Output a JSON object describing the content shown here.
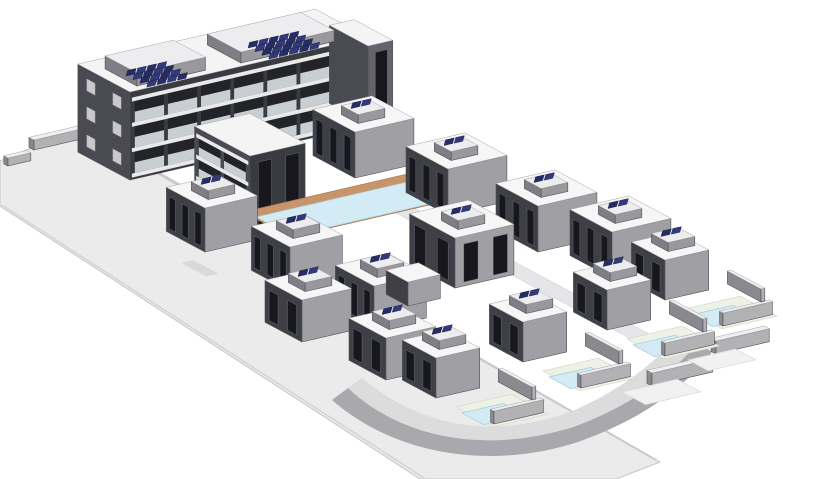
{
  "scene": {
    "name": "residential-complex-3d-axonometric-render",
    "canvas": {
      "width": 815,
      "height": 479,
      "background": "#ffffff"
    },
    "projection": {
      "u": [
        0.95,
        -0.22
      ],
      "v": [
        0.84,
        0.45
      ]
    },
    "palette": {
      "road": "#ebebeb",
      "roadEdge": "#c4c4c6",
      "street": "#e6e6e8",
      "drive": "#d9d9da",
      "curve": "#a9a9ad",
      "curveWalk": "#dcdcdd",
      "wallL": "#8a8a8e",
      "wallR": "#b2b2b5",
      "wallTop": "#efeff0",
      "houseL": "#3f3f46",
      "houseR": "#a0a0a4",
      "houseTop": "#f6f6f7",
      "aptL": "#4a4a52",
      "aptR": "#3a3a41",
      "aptTop": "#f4f4f5",
      "aptR2": "#63636b",
      "rbL": "#7e7e84",
      "rbR": "#98989d",
      "rbTop": "#ededef",
      "window": "#17171d",
      "winFrame": "#6a7688",
      "balcony": "#23232a",
      "railing": "#c9ced2",
      "slab": "#e9e9ea",
      "sqwin": "#c9c9cc",
      "solar": "#262c66",
      "solar2": "#323a7d",
      "solarEdge": "#141839",
      "deck": "#c8956a",
      "deckEdge": "#a87848",
      "water": "#d3ebf4",
      "waterEdge": "#a5ccda",
      "garden": "#edf1e6",
      "gardenEdge": "#d3dac6",
      "edge": "#4f4f57",
      "topEdge": "#a6a6aa"
    },
    "items": [
      {
        "t": "poly",
        "name": "main-road",
        "pts": [
          [
            86,
            130
          ],
          [
            660,
            462
          ],
          [
            616,
            479
          ],
          [
            420,
            479
          ],
          [
            0,
            206
          ],
          [
            0,
            161
          ],
          [
            55,
            138
          ]
        ],
        "fill": "road",
        "stroke": "roadEdge",
        "sw": 1
      },
      {
        "t": "path",
        "name": "road-upper-curb",
        "d": "M 86 132 L 656 460",
        "stroke": "#c9c9cb",
        "sw": 2
      },
      {
        "t": "path",
        "name": "road-lower-edge",
        "d": "M 2 205 L 424 478",
        "stroke": "#d4d4d5",
        "sw": 1.5
      },
      {
        "t": "box",
        "name": "retaining-wall-1",
        "a": [
          34,
          150
        ],
        "w": 55,
        "d": 6,
        "h": 10
      },
      {
        "t": "box",
        "name": "retaining-wall-2",
        "a": [
          8,
          166
        ],
        "w": 24,
        "d": 5,
        "h": 8
      },
      {
        "t": "rect",
        "name": "inner-street",
        "a": [
          383,
          206
        ],
        "w": 20,
        "d": 330,
        "fill": "street",
        "stroke": "#d5d5d6"
      },
      {
        "t": "path",
        "name": "curved-road",
        "d": "M 332 400 C 396 456 492 470 578 442 C 640 420 682 390 712 352 L 698 342 C 670 376 634 404 576 426 C 496 452 408 444 348 388 Z",
        "fill": "curve"
      },
      {
        "t": "path",
        "name": "curved-sidewalk",
        "d": "M 348 388 C 408 444 496 452 576 426 C 634 404 670 376 698 342 L 682 331 C 656 362 622 390 570 412 C 498 438 424 430 362 378 Z",
        "fill": "curveWalk"
      },
      {
        "t": "rect",
        "name": "driveway-1",
        "a": [
          181,
          263
        ],
        "w": 13,
        "d": 30,
        "fill": "drive"
      },
      {
        "t": "rect",
        "name": "driveway-2",
        "a": [
          266,
          302
        ],
        "w": 13,
        "d": 30,
        "fill": "drive"
      },
      {
        "t": "rect",
        "name": "driveway-3",
        "a": [
          350,
          340
        ],
        "w": 13,
        "d": 30,
        "fill": "drive"
      },
      {
        "t": "box",
        "name": "apartment-block",
        "a": [
          130,
          180
        ],
        "w": 250,
        "d": 62,
        "h": 88,
        "top": "aptTop",
        "left": "aptL",
        "right": "aptR"
      },
      {
        "t": "balc",
        "name": "apartment-balconies",
        "a": [
          130,
          180
        ],
        "w": 250,
        "h": 88,
        "rows": 3,
        "cols": 7
      },
      {
        "t": "sqwin",
        "name": "apartment-end-windows",
        "a": [
          130,
          180
        ],
        "d": 62,
        "h": 88,
        "rows": 3,
        "cols": 2
      },
      {
        "t": "box",
        "name": "apartment-end-block",
        "a": [
          368,
          124
        ],
        "w": 26,
        "d": 46,
        "h": 78,
        "top": "aptTop",
        "left": "aptL",
        "right": "aptR2"
      },
      {
        "t": "winR",
        "name": "apartment-end-block-windows",
        "a": [
          368,
          124
        ],
        "w": 26,
        "h": 78,
        "n": 1
      },
      {
        "t": "box",
        "name": "apartment-roof-house-1",
        "a": [
          137,
          86
        ],
        "w": 72,
        "d": 38,
        "h": 13,
        "top": "rbTop",
        "left": "rbL",
        "right": "rbR"
      },
      {
        "t": "solar",
        "name": "solar-array-1",
        "at": [
          126,
          76
        ],
        "rows": 4,
        "cols": 4
      },
      {
        "t": "box",
        "name": "apartment-roof-house-2",
        "a": [
          241,
          63
        ],
        "w": 98,
        "d": 40,
        "h": 11,
        "top": "rbTop",
        "left": "rbL",
        "right": "rbR"
      },
      {
        "t": "solar",
        "name": "solar-array-2",
        "at": [
          248,
          48
        ],
        "rows": 4,
        "cols": 5
      },
      {
        "t": "box",
        "name": "apartment-wing",
        "a": [
          250,
          232
        ],
        "w": 58,
        "d": 66,
        "h": 76,
        "top": "aptTop",
        "left": "aptL",
        "right": "aptR"
      },
      {
        "t": "balcL",
        "name": "apartment-wing-balconies",
        "a": [
          250,
          232
        ],
        "d": 66,
        "h": 76,
        "rows": 3,
        "cols": 2
      },
      {
        "t": "winR",
        "name": "apartment-wing-windows",
        "a": [
          250,
          232
        ],
        "w": 58,
        "h": 76,
        "n": 2
      },
      {
        "t": "rect",
        "name": "pool-deck",
        "a": [
          243,
          212
        ],
        "w": 185,
        "d": 56,
        "fill": "deck",
        "stroke": "deckEdge"
      },
      {
        "t": "rect",
        "name": "pool-water",
        "a": [
          256,
          217
        ],
        "w": 160,
        "d": 42,
        "fill": "water",
        "stroke": "waterEdge"
      },
      {
        "t": "house",
        "name": "townhouse-l1",
        "a": [
          205,
          252
        ],
        "w": 55,
        "d": 46,
        "h": 44,
        "win": 3
      },
      {
        "t": "house",
        "name": "townhouse-l2",
        "a": [
          290,
          291
        ],
        "w": 55,
        "d": 46,
        "h": 44,
        "win": 3
      },
      {
        "t": "house",
        "name": "townhouse-l3",
        "a": [
          374,
          330
        ],
        "w": 55,
        "d": 46,
        "h": 44,
        "win": 3
      },
      {
        "t": "house",
        "name": "townhouse-r1",
        "a": [
          355,
          178
        ],
        "w": 62,
        "d": 50,
        "h": 46,
        "win": 3
      },
      {
        "t": "house",
        "name": "townhouse-r2",
        "a": [
          448,
          215
        ],
        "w": 62,
        "d": 50,
        "h": 46,
        "win": 3
      },
      {
        "t": "house",
        "name": "townhouse-r3",
        "a": [
          538,
          252
        ],
        "w": 62,
        "d": 50,
        "h": 46,
        "win": 3
      },
      {
        "t": "house",
        "name": "townhouse-r4",
        "a": [
          612,
          278
        ],
        "w": 62,
        "d": 50,
        "h": 46,
        "win": 3
      },
      {
        "t": "house",
        "name": "pool-house",
        "a": [
          455,
          288
        ],
        "w": 62,
        "d": 54,
        "h": 50,
        "win": 2
      },
      {
        "t": "winR",
        "name": "pool-house-windows",
        "a": [
          455,
          288
        ],
        "w": 62,
        "h": 50,
        "n": 2
      },
      {
        "t": "box",
        "name": "pool-house-wing",
        "a": [
          408,
          306
        ],
        "w": 34,
        "d": 26,
        "h": 24,
        "top": "houseTop",
        "left": "houseL",
        "right": "houseR"
      },
      {
        "t": "house",
        "name": "house-m1",
        "a": [
          302,
          342
        ],
        "w": 52,
        "d": 44,
        "h": 42,
        "win": 2
      },
      {
        "t": "house",
        "name": "house-m2",
        "a": [
          386,
          380
        ],
        "w": 52,
        "d": 44,
        "h": 42,
        "win": 2
      },
      {
        "t": "box",
        "name": "terrace-wall-1",
        "a": [
          652,
          386
        ],
        "w": 64,
        "d": 6,
        "h": 13
      },
      {
        "t": "box",
        "name": "terrace-wall-2",
        "a": [
          716,
          354
        ],
        "w": 56,
        "d": 6,
        "h": 13
      },
      {
        "t": "rect",
        "name": "terrace-platform-1",
        "a": [
          622,
          392
        ],
        "w": 58,
        "d": 28,
        "fill": "#f1f1f2",
        "stroke": "#d8d8d9"
      },
      {
        "t": "rect",
        "name": "terrace-platform-2",
        "a": [
          688,
          360
        ],
        "w": 50,
        "d": 24,
        "fill": "#f1f1f2",
        "stroke": "#d8d8d9"
      },
      {
        "t": "villa",
        "name": "villa-4",
        "a": [
          665,
          300
        ]
      },
      {
        "t": "villa",
        "name": "villa-3",
        "a": [
          607,
          330
        ]
      },
      {
        "t": "villa",
        "name": "villa-2",
        "a": [
          523,
          362
        ]
      },
      {
        "t": "villa",
        "name": "villa-1",
        "a": [
          436,
          398
        ]
      }
    ]
  }
}
